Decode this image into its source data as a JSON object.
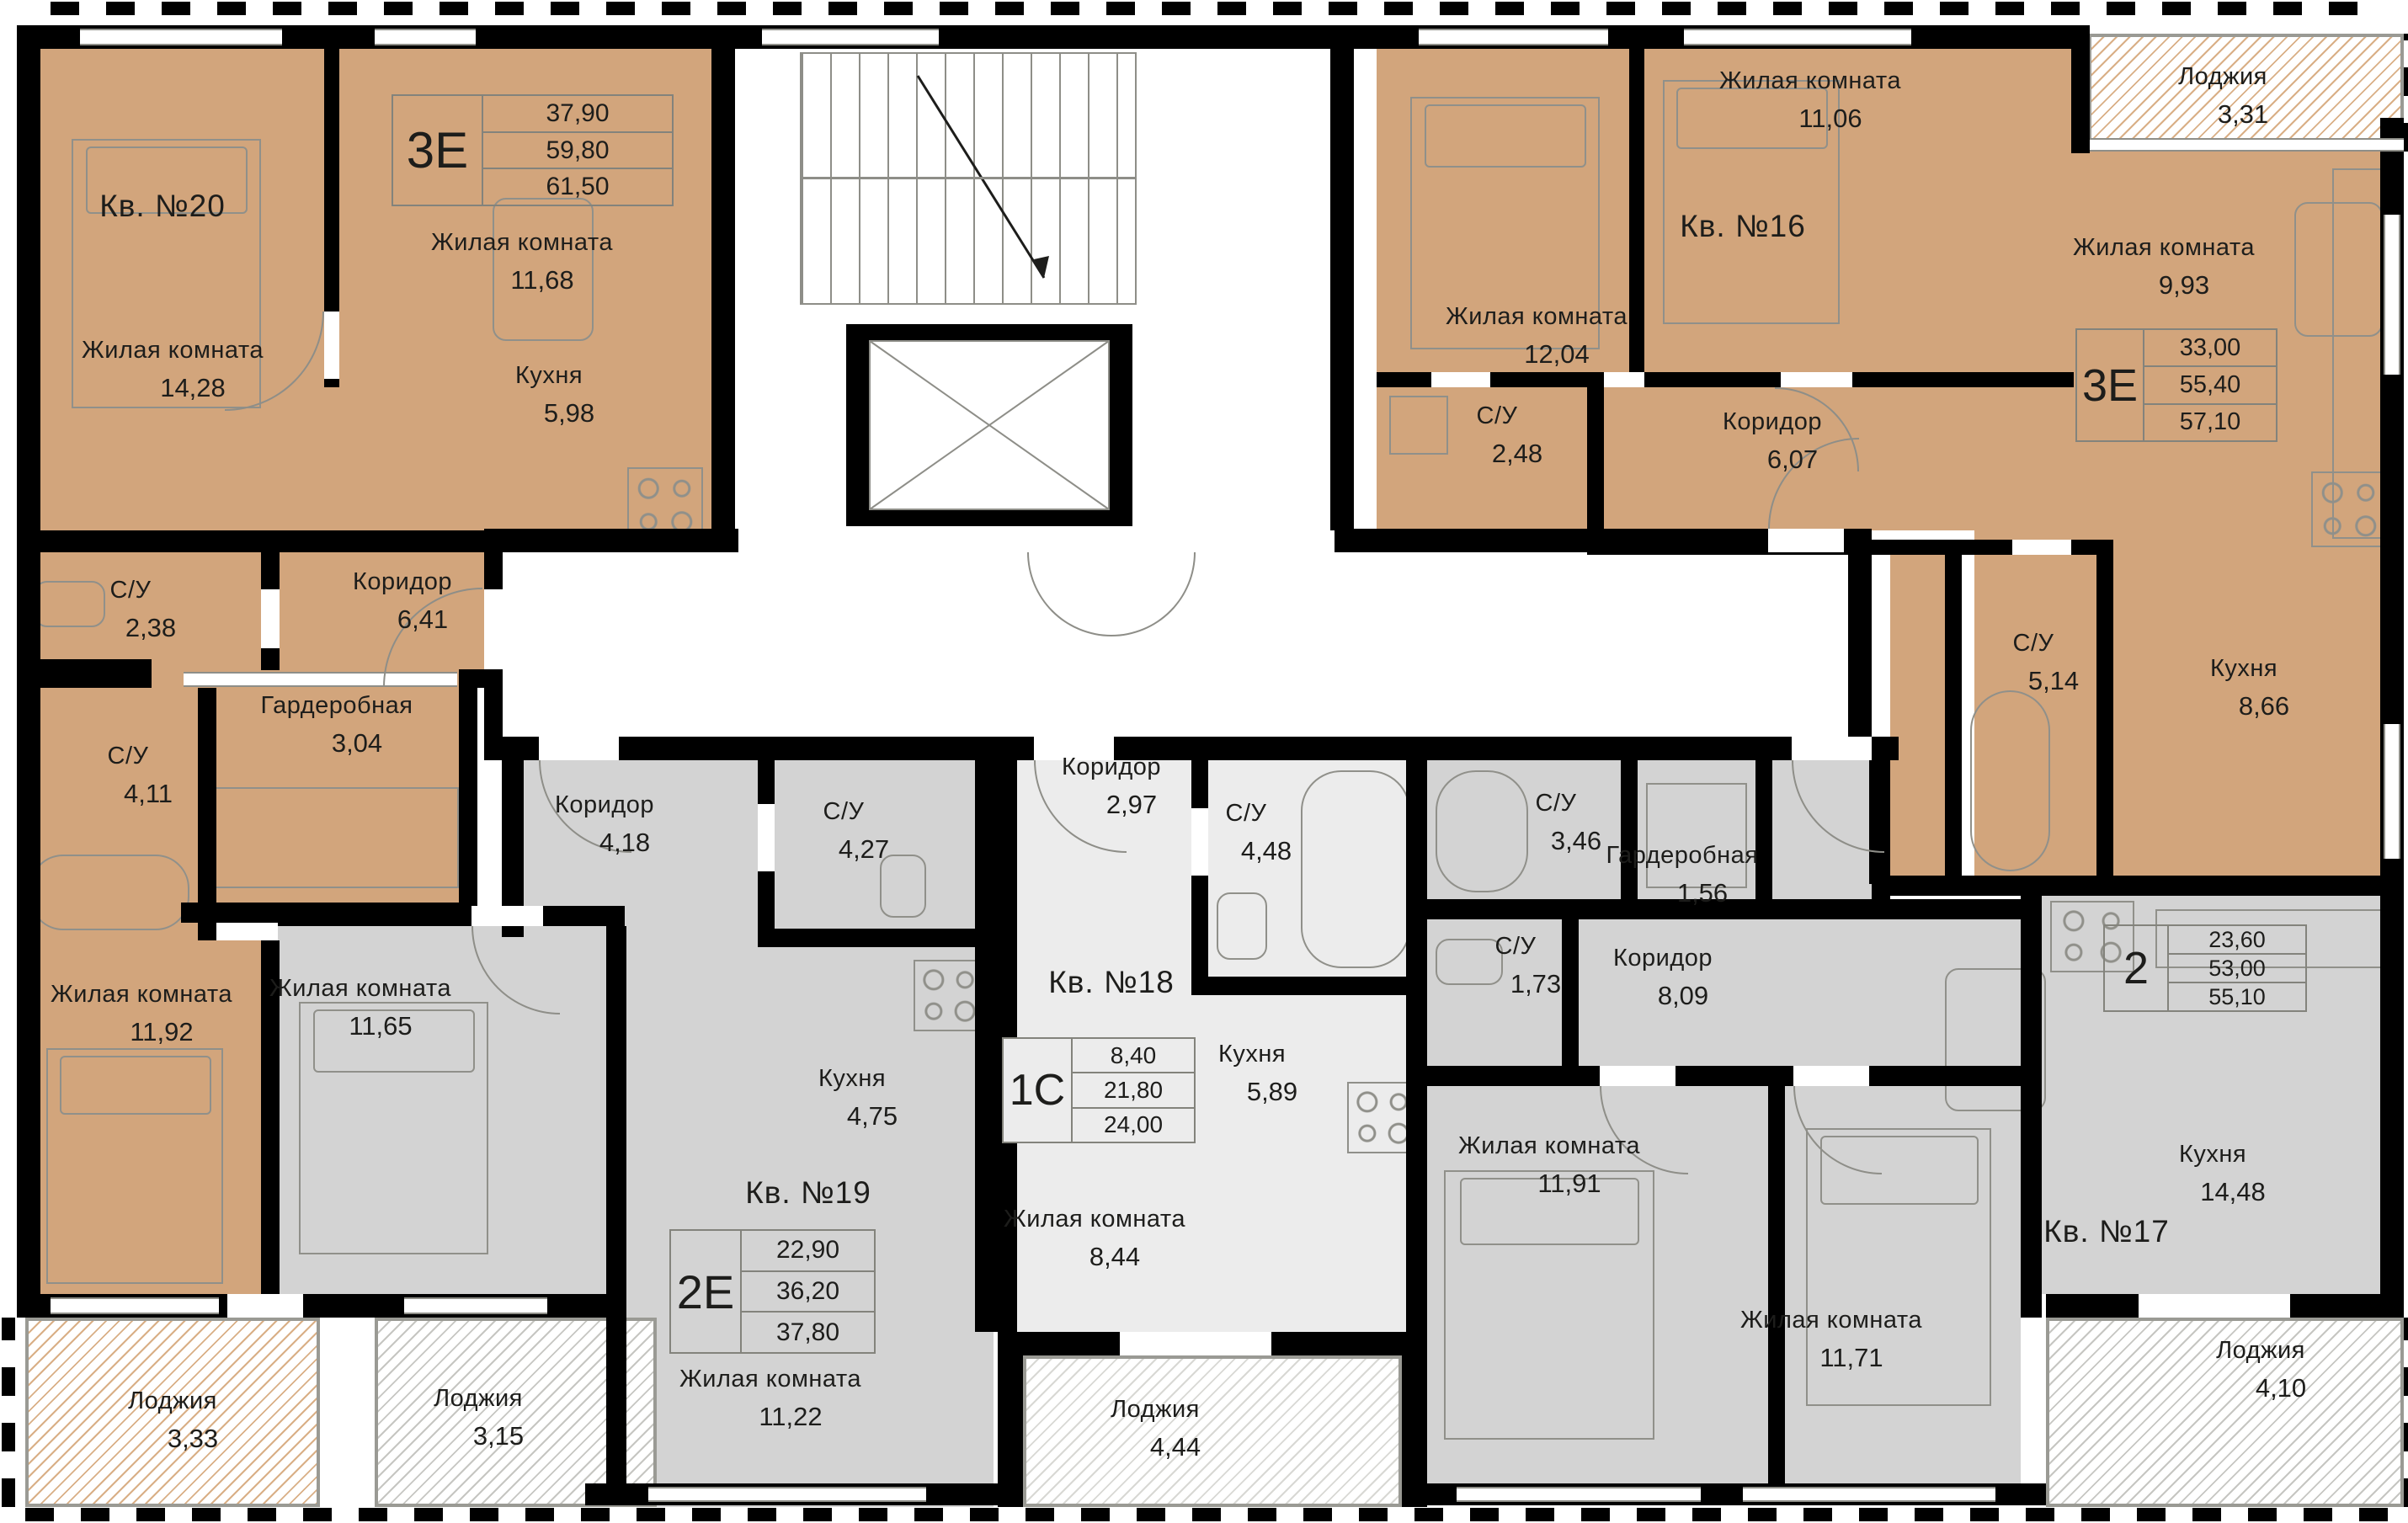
{
  "colors": {
    "apartment_brown": "#d2a57c",
    "apartment_gray": "#d3d3d3",
    "apartment_light": "#ececec",
    "wall": "#000000",
    "furniture_line": "#90908a",
    "text": "#1d1d1b"
  },
  "apartments": {
    "kv20": {
      "number": "Кв. №20",
      "type": "3Е",
      "area_living": "37,90",
      "area_apartment": "59,80",
      "area_total": "61,50",
      "rooms": {
        "living1": {
          "name": "Жилая комната",
          "area": "14,28"
        },
        "living2": {
          "name": "Жилая комната",
          "area": "11,68"
        },
        "kitchen": {
          "name": "Кухня",
          "area": "5,98"
        },
        "su1": {
          "name": "С/У",
          "area": "2,38"
        },
        "corridor": {
          "name": "Коридор",
          "area": "6,41"
        },
        "wardrobe": {
          "name": "Гардеробная",
          "area": "3,04"
        },
        "su2": {
          "name": "С/У",
          "area": "4,11"
        },
        "living3": {
          "name": "Жилая комната",
          "area": "11,92"
        },
        "loggia": {
          "name": "Лоджия",
          "area": "3,33"
        }
      }
    },
    "kv16": {
      "number": "Кв. №16",
      "type": "3Е",
      "area_living": "33,00",
      "area_apartment": "55,40",
      "area_total": "57,10",
      "rooms": {
        "living1": {
          "name": "Жилая комната",
          "area": "11,06"
        },
        "living2": {
          "name": "Жилая комната",
          "area": "12,04"
        },
        "su1": {
          "name": "С/У",
          "area": "2,48"
        },
        "corridor": {
          "name": "Коридор",
          "area": "6,07"
        },
        "living3": {
          "name": "Жилая комната",
          "area": "9,93"
        },
        "loggia": {
          "name": "Лоджия",
          "area": "3,31"
        },
        "su2": {
          "name": "С/У",
          "area": "5,14"
        },
        "kitchen": {
          "name": "Кухня",
          "area": "8,66"
        }
      }
    },
    "kv19": {
      "number": "Кв. №19",
      "type": "2Е",
      "area_living": "22,90",
      "area_apartment": "36,20",
      "area_total": "37,80",
      "rooms": {
        "corridor": {
          "name": "Коридор",
          "area": "4,18"
        },
        "su": {
          "name": "С/У",
          "area": "4,27"
        },
        "living1": {
          "name": "Жилая комната",
          "area": "11,65"
        },
        "kitchen": {
          "name": "Кухня",
          "area": "4,75"
        },
        "living2": {
          "name": "Жилая комната",
          "area": "11,22"
        },
        "loggia": {
          "name": "Лоджия",
          "area": "3,15"
        }
      }
    },
    "kv18": {
      "number": "Кв. №18",
      "type": "1С",
      "area_living": "8,40",
      "area_apartment": "21,80",
      "area_total": "24,00",
      "rooms": {
        "corridor": {
          "name": "Коридор",
          "area": "2,97"
        },
        "su": {
          "name": "С/У",
          "area": "4,48"
        },
        "kitchen": {
          "name": "Кухня",
          "area": "5,89"
        },
        "living": {
          "name": "Жилая комната",
          "area": "8,44"
        },
        "loggia": {
          "name": "Лоджия",
          "area": "4,44"
        }
      }
    },
    "kv17": {
      "number": "Кв. №17",
      "type": "2",
      "area_living": "23,60",
      "area_apartment": "53,00",
      "area_total": "55,10",
      "rooms": {
        "su1": {
          "name": "С/У",
          "area": "3,46"
        },
        "wardrobe": {
          "name": "Гардеробная",
          "area": "1,56"
        },
        "su2": {
          "name": "С/У",
          "area": "1,73"
        },
        "corridor": {
          "name": "Коридор",
          "area": "8,09"
        },
        "living1": {
          "name": "Жилая комната",
          "area": "11,91"
        },
        "living2": {
          "name": "Жилая комната",
          "area": "11,71"
        },
        "kitchen": {
          "name": "Кухня",
          "area": "14,48"
        },
        "loggia": {
          "name": "Лоджия",
          "area": "4,10"
        }
      }
    }
  }
}
